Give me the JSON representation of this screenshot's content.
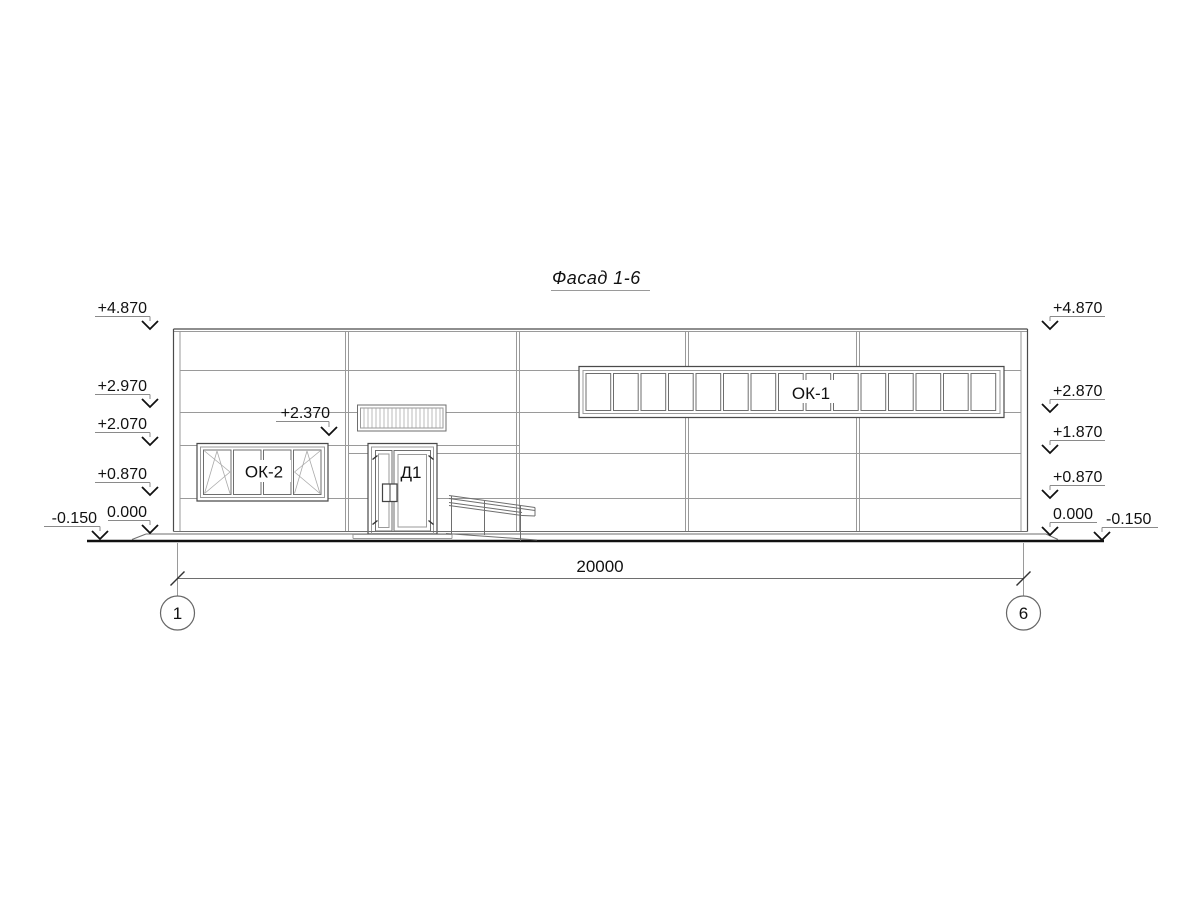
{
  "drawing": {
    "title": "Фасад 1-6",
    "dimension_total": "20000",
    "grid_axis_left": "1",
    "grid_axis_right": "6",
    "labels": {
      "strip_window": "ОК-1",
      "window": "ОК-2",
      "door": "Д1"
    },
    "elev_left": [
      "+4.870",
      "+2.970",
      "+2.070",
      "+0.870",
      "0.000",
      "-0.150"
    ],
    "elev_right": [
      "+4.870",
      "+2.870",
      "+1.870",
      "+0.870",
      "0.000",
      "-0.150"
    ],
    "elev_louver": "+2.370",
    "colors": {
      "line_dark": "#4a4a4a",
      "line_light": "#9a9a9a",
      "ground_line": "#111111",
      "text": "#111111",
      "background": "#ffffff"
    }
  }
}
